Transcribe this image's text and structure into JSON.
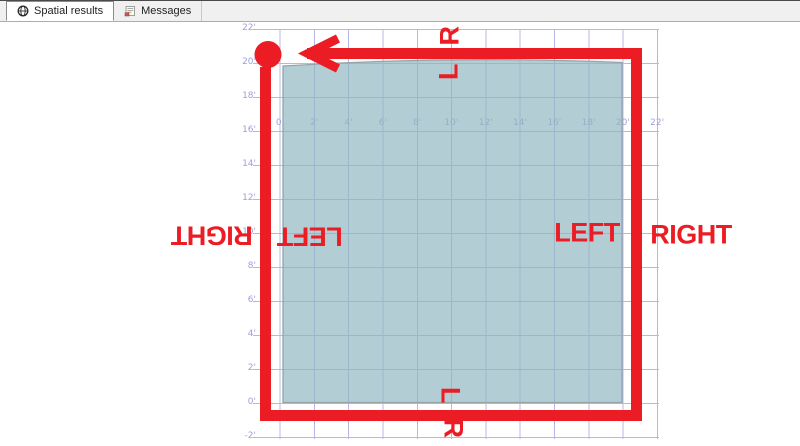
{
  "tab_bar": {
    "tabs": [
      {
        "label": "Spatial results",
        "icon": "globe-icon",
        "active": true
      },
      {
        "label": "Messages",
        "icon": "messages-icon",
        "active": false
      }
    ]
  },
  "spatial_view": {
    "x_axis_labels": [
      "0'",
      "2'",
      "4'",
      "6'",
      "8'",
      "10'",
      "12'",
      "14'",
      "16'",
      "18'",
      "20'",
      "22'"
    ],
    "y_axis_labels": [
      "22'",
      "20'",
      "18'",
      "16'",
      "14'",
      "12'",
      "10'",
      "8'",
      "6'",
      "4'",
      "2'",
      "0'",
      "-2'"
    ],
    "polygon": {
      "x_extent_ft": [
        0,
        20
      ],
      "y_extent_ft": [
        0,
        20
      ]
    }
  },
  "annotations": {
    "top_outside_letter": "R",
    "top_inside_letter": "L",
    "left_outside_label": "RIGHT",
    "left_inside_label": "LEFT",
    "right_inside_label": "LEFT",
    "right_outside_label": "RIGHT",
    "bottom_inside_letter": "L",
    "bottom_outside_letter": "R"
  },
  "colors": {
    "annotation_red": "#ec1c24",
    "grid_line": "#b7b7e6",
    "axis_label": "#9e9ede",
    "polygon_fill": "#8fb6c0",
    "polygon_border": "#94a4a9"
  }
}
